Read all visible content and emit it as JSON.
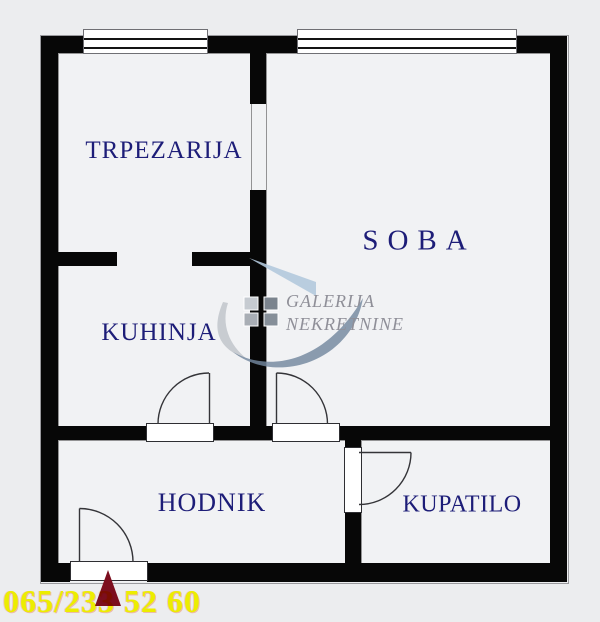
{
  "title": "Apartment floor plan",
  "rooms": [
    {
      "name": "dining-room",
      "label": "TRPEZARIJA"
    },
    {
      "name": "room",
      "label": "SOBA"
    },
    {
      "name": "kitchen",
      "label": "KUHINJA"
    },
    {
      "name": "hallway",
      "label": "HODNIK"
    },
    {
      "name": "bathroom",
      "label": "KUPATILO"
    }
  ],
  "watermark": {
    "agency_line1": "GALERIJA",
    "agency_line2": "NEKRETNINE",
    "logo_icon": "roof-swoosh-logo",
    "squares_icon": "four-squares-logo"
  },
  "footer": {
    "phone": "065/233 52 60",
    "entrance_marker_icon": "entrance-arrow"
  },
  "colors": {
    "background": "#ecedef",
    "floor": "#f1f2f4",
    "wall": "#070707",
    "room_label": "#1d1d78",
    "phone_text": "#ffff00",
    "entrance_marker": "#7c0e1e",
    "watermark_text": "#8f8f98",
    "watermark_blue": "#b3c9dd",
    "watermark_steel": "#73879f",
    "watermark_gray": "#c5c9cf"
  }
}
